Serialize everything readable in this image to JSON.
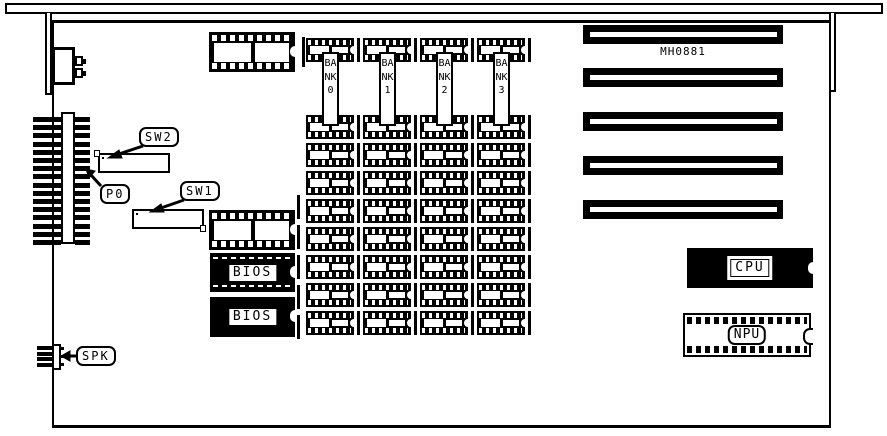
{
  "board": {
    "model_text": "MH0881",
    "type": "motherboard-diagram"
  },
  "colors": {
    "ink": "#000000",
    "background": "#ffffff"
  },
  "memory": {
    "banks": [
      {
        "label": "BANK0",
        "chips": 9
      },
      {
        "label": "BANK1",
        "chips": 9
      },
      {
        "label": "BANK2",
        "chips": 9
      },
      {
        "label": "BANK3",
        "chips": 9
      }
    ]
  },
  "switches": [
    {
      "id": "sw2",
      "label": "SW2",
      "positions": 8,
      "pattern": [
        "off",
        "on",
        "on",
        "on",
        "on",
        "on",
        "on",
        "on"
      ],
      "notch_corner": "top-left"
    },
    {
      "id": "sw1",
      "label": "SW1",
      "positions": 8,
      "pattern": [
        "on",
        "on",
        "on",
        "on",
        "on",
        "on",
        "on",
        "off"
      ],
      "notch_corner": "bottom-right"
    }
  ],
  "connectors": [
    {
      "id": "p0",
      "label": "P0",
      "type": "edge-connector",
      "pins": 16
    },
    {
      "id": "spk",
      "label": "SPK",
      "type": "speaker-header",
      "pins": 4
    },
    {
      "id": "kbd",
      "type": "keyboard-connector"
    }
  ],
  "chips": [
    {
      "id": "cpu",
      "label": "CPU"
    },
    {
      "id": "npu",
      "label": "NPU"
    },
    {
      "id": "bios1",
      "label": "BIOS"
    },
    {
      "id": "bios2",
      "label": "BIOS"
    }
  ],
  "expansion_slots": {
    "count": 5
  }
}
